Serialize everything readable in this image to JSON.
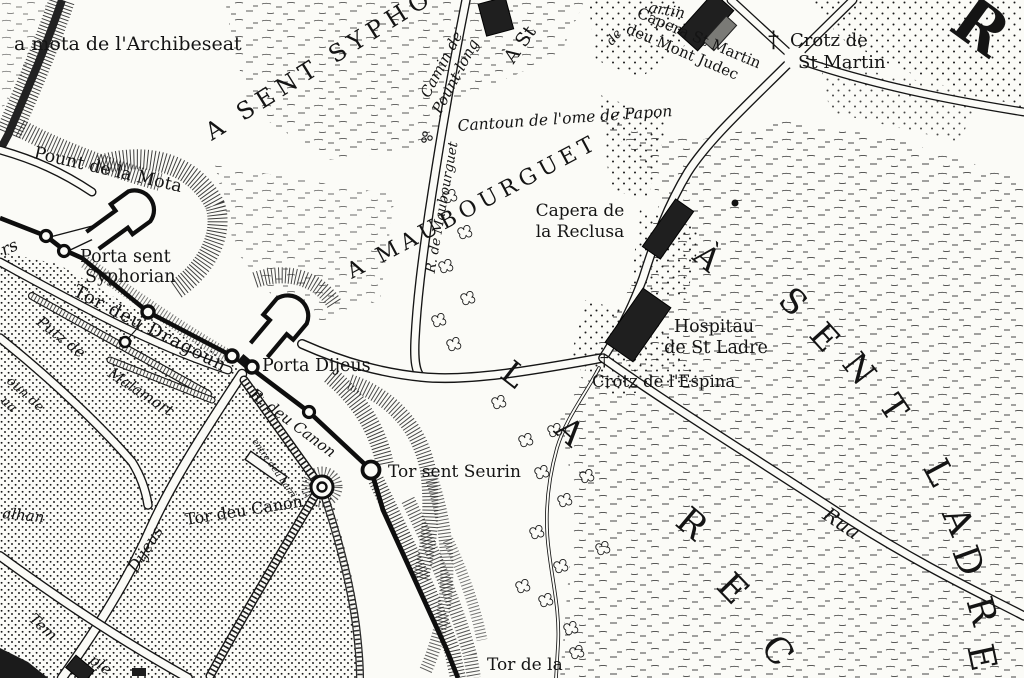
{
  "map": {
    "colors": {
      "paper": "#fbfbf7",
      "ink": "#141414"
    },
    "labels": {
      "archibescat": "a mota de l'Archibeseat",
      "sent_syphorian_road": "A SENT SYPHORIAN",
      "camin_line1": "Camin de",
      "camin_line2": "Pount-long",
      "a_st": "À St",
      "frag_artin": "artin",
      "frag_de": "de",
      "capera_martin_l1": "Capera St Martin",
      "capera_martin_l2": "deu Mont Judec",
      "cross_martin": "†",
      "crotz_martin_l1": "Crotz de",
      "crotz_martin_l2": "St Martin",
      "big_r": "R",
      "pount_mota": "Pount de la Mota",
      "porta_syph_l1": "Porta sent",
      "porta_syph_l2": "Syphorian",
      "frag_rs": "rs",
      "maubourguet_road": "A MAUBOURGUET",
      "r_maubourguet": "R. de Maubourguet",
      "cantoun_papon": "Cantoun de l'ome de Papon",
      "capera_reclusa_l1": "Capera de",
      "capera_reclusa_l2": "la Reclusa",
      "hospitau_l1": "Hospitau",
      "hospitau_l2": "de St Ladre",
      "cross_espina": "†",
      "crotz_espina": "Crotz de l'Espina",
      "rua": "Rua",
      "tor_sent_seurin": "Tor sent Seurin",
      "tor_dragoun": "Tor deu Dragoun",
      "putz_l1": "Putz de",
      "putz_l2": "Malamort",
      "porta_dijeus": "Porta Dijeus",
      "r_canon": "R. deu Canon",
      "dijeus_street": "Dijeus",
      "tor_canon": "Tor deu Canon",
      "entre_barri": "entre deu barri",
      "frag_alhan": "alhan",
      "frag_oun_de": "oun de",
      "frag_ua": "ua",
      "temple_l1": "Tem",
      "temple_l2": "ple",
      "tor_de_la": "Tor de la"
    },
    "region_letters": {
      "sent_ladre": [
        "À",
        "S",
        "E",
        "N",
        "T",
        "L",
        "A",
        "D",
        "R",
        "E"
      ],
      "la_rec": [
        "L",
        "A",
        "R",
        "E",
        "C"
      ]
    }
  }
}
